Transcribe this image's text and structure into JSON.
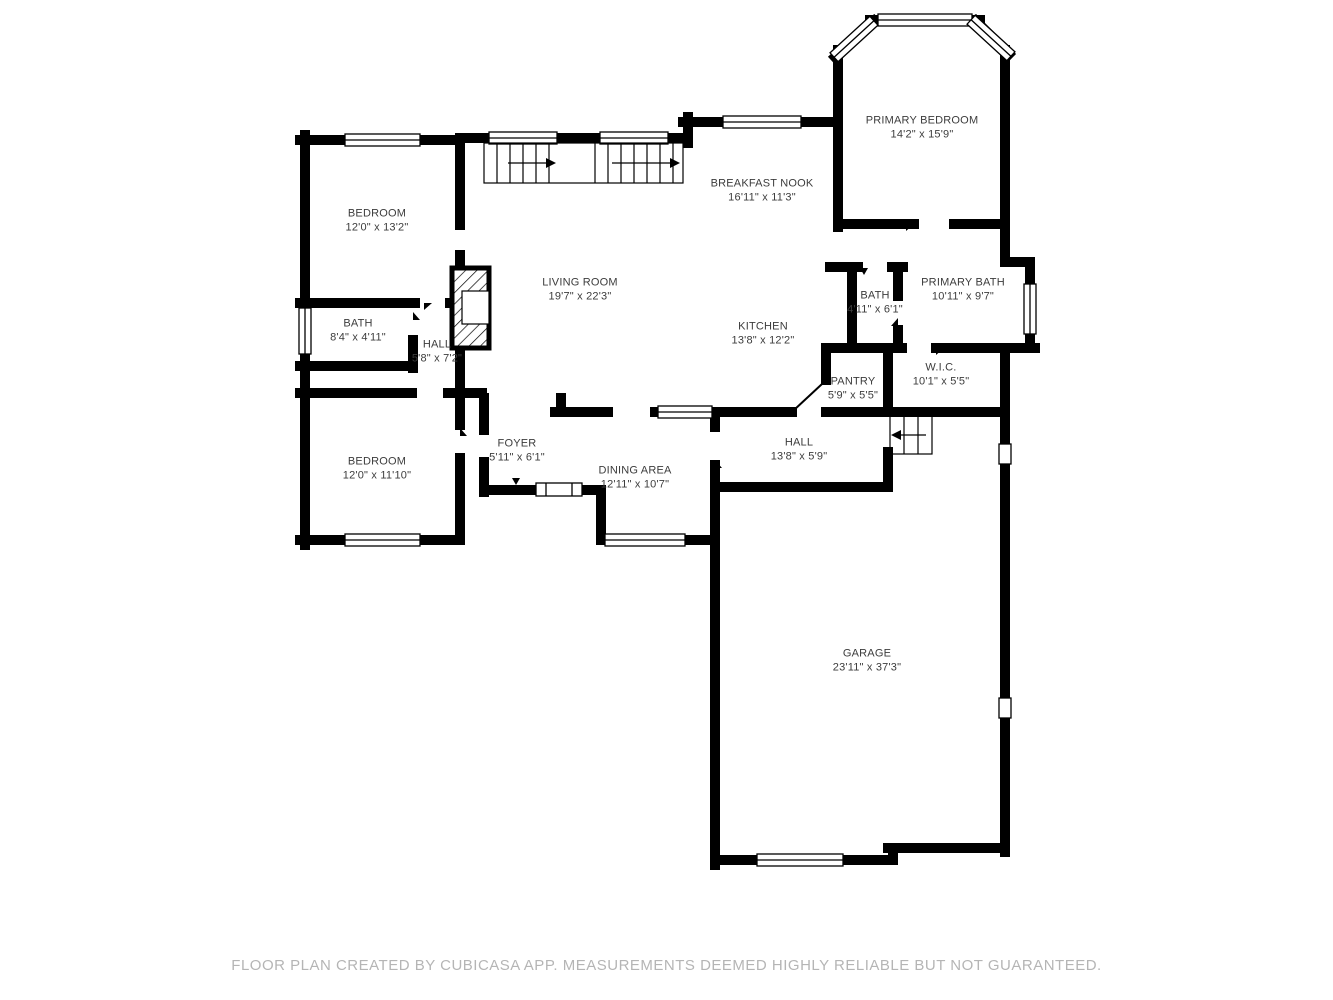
{
  "footer": {
    "text": "FLOOR PLAN CREATED BY CUBICASA APP. MEASUREMENTS DEEMED HIGHLY RELIABLE BUT NOT GUARANTEED."
  },
  "colors": {
    "wall": "#000000",
    "background": "#ffffff",
    "label_text": "#3c3c3c",
    "footer_text": "#b5b5b5"
  },
  "rooms": [
    {
      "name": "PRIMARY BEDROOM",
      "dims": "14'2\" x 15'9\""
    },
    {
      "name": "BREAKFAST NOOK",
      "dims": "16'11\" x 11'3\""
    },
    {
      "name": "BEDROOM",
      "dims": "12'0\" x 13'2\""
    },
    {
      "name": "LIVING ROOM",
      "dims": "19'7\" x 22'3\""
    },
    {
      "name": "BATH",
      "dims": "8'4\" x 4'11\""
    },
    {
      "name": "HALL",
      "dims": "5'8\" x 7'2\""
    },
    {
      "name": "PRIMARY BATH",
      "dims": "10'11\" x 9'7\""
    },
    {
      "name": "BATH",
      "dims": "4'11\" x 6'1\""
    },
    {
      "name": "KITCHEN",
      "dims": "13'8\" x 12'2\""
    },
    {
      "name": "PANTRY",
      "dims": "5'9\" x 5'5\""
    },
    {
      "name": "W.I.C.",
      "dims": "10'1\" x 5'5\""
    },
    {
      "name": "BEDROOM",
      "dims": "12'0\" x 11'10\""
    },
    {
      "name": "FOYER",
      "dims": "5'11\" x 6'1\""
    },
    {
      "name": "DINING AREA",
      "dims": "12'11\" x 10'7\""
    },
    {
      "name": "HALL",
      "dims": "13'8\" x 5'9\""
    },
    {
      "name": "GARAGE",
      "dims": "23'11\" x 37'3\""
    }
  ]
}
